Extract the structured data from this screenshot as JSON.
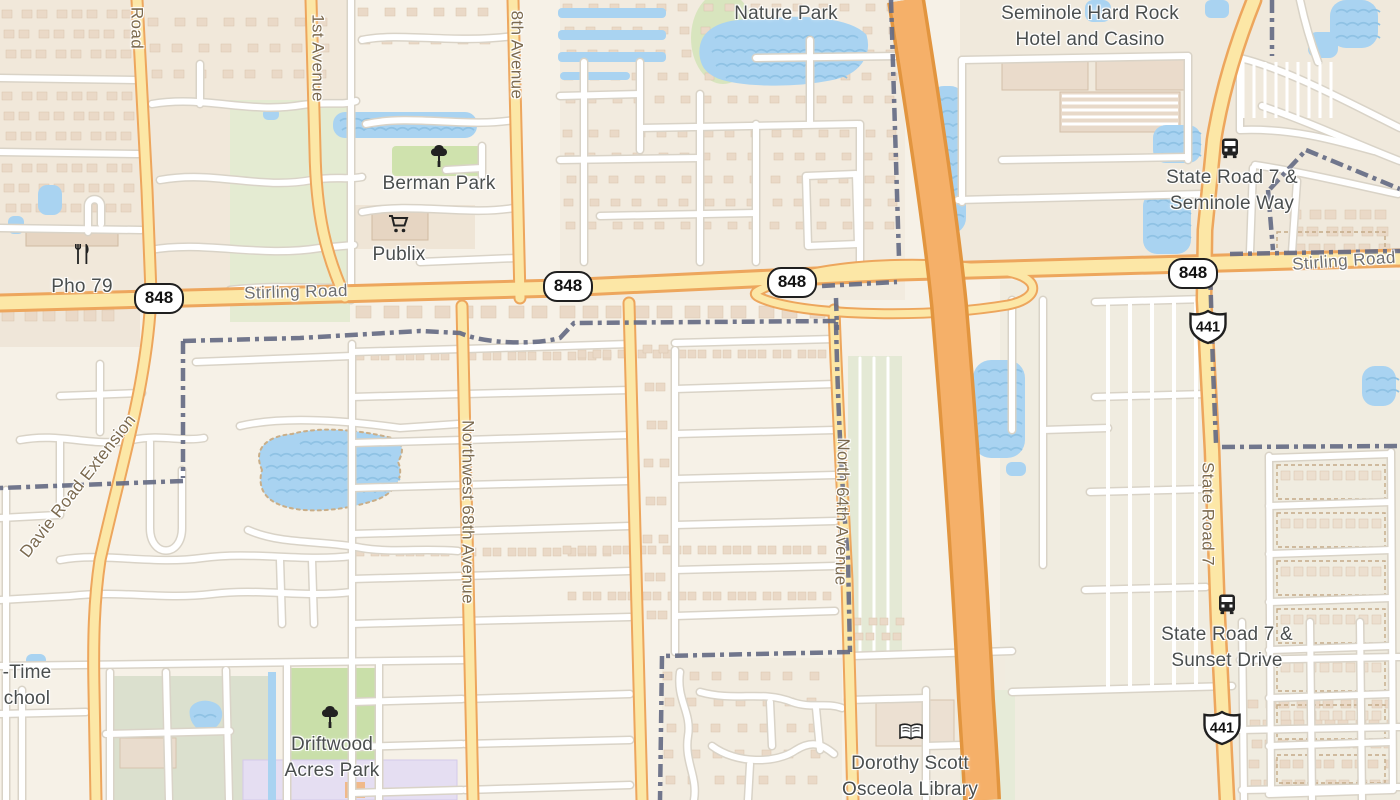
{
  "map": {
    "canvas": {
      "width": 1400,
      "height": 800
    },
    "colors": {
      "land": "#f6f1e7",
      "water": "#a9d3f1",
      "wave": "#8fc2e4",
      "park_green": "#cfe2ad",
      "school_green": "#dbe0ce",
      "road_yellow_fill": "#fce7a6",
      "road_yellow_casing": "#eda65d",
      "highway_fill": "#f5b069",
      "highway_casing": "#e2953f",
      "minor_road_fill": "#ffffff",
      "minor_road_casing": "#d9d3c7",
      "boundary_dash": "#656b84",
      "building": "#ead9c7",
      "campus_purple": "#e5def2",
      "label_place": "#4a4e4e",
      "label_road": "#6e6e6e",
      "label_avenue": "#7b6a4f"
    },
    "labels": [
      {
        "id": "nature-park",
        "kind": "place",
        "text": "Nature Park",
        "x": 786,
        "y": 14
      },
      {
        "id": "seminole-hard-rock",
        "kind": "place",
        "lines": [
          "Seminole Hard Rock",
          "Hotel and Casino"
        ],
        "x": 1090,
        "y": 27
      },
      {
        "id": "state-road-7-seminole-way",
        "kind": "place",
        "lines": [
          "State Road 7 &",
          "Seminole Way"
        ],
        "x": 1232,
        "y": 191
      },
      {
        "id": "state-road-7-sunset-drive",
        "kind": "place",
        "lines": [
          "State Road 7 &",
          "Sunset Drive"
        ],
        "x": 1227,
        "y": 648
      },
      {
        "id": "dorothy-scott-osceola-library",
        "kind": "place",
        "lines": [
          "Dorothy Scott",
          "Osceola Library"
        ],
        "x": 910,
        "y": 777
      },
      {
        "id": "driftwood-acres-park",
        "kind": "place",
        "lines": [
          "Driftwood",
          "Acres Park"
        ],
        "x": 332,
        "y": 758
      },
      {
        "id": "berman-park",
        "kind": "place",
        "text": "Berman Park",
        "x": 439,
        "y": 184
      },
      {
        "id": "publix",
        "kind": "place",
        "text": "Publix",
        "x": 399,
        "y": 255
      },
      {
        "id": "pho-79",
        "kind": "place",
        "text": "Pho 79",
        "x": 82,
        "y": 287
      },
      {
        "id": "school-label-clipped",
        "kind": "place",
        "lines": [
          "-Time",
          "chool"
        ],
        "x": 27,
        "y": 686
      },
      {
        "id": "stirling-road-west",
        "kind": "road",
        "text": "Stirling Road",
        "x": 296,
        "y": 292,
        "rotate": -1.5
      },
      {
        "id": "stirling-road-east",
        "kind": "road",
        "text": "Stirling Road",
        "x": 1344,
        "y": 261,
        "rotate": -4
      },
      {
        "id": "davie-road",
        "kind": "avenue",
        "text": "Road",
        "x": 137,
        "y": 28,
        "rotate": 90
      },
      {
        "id": "1st-avenue",
        "kind": "avenue",
        "text": "1st Avenue",
        "x": 318,
        "y": 58,
        "rotate": 90
      },
      {
        "id": "8th-avenue",
        "kind": "avenue",
        "text": "8th Avenue",
        "x": 517,
        "y": 55,
        "rotate": 90
      },
      {
        "id": "northwest-68th-avenue",
        "kind": "avenue",
        "text": "Northwest 68th Avenue",
        "x": 468,
        "y": 512,
        "rotate": 90
      },
      {
        "id": "north-64th-avenue",
        "kind": "avenue",
        "text": "North 64th Avenue",
        "x": 842,
        "y": 512,
        "rotate": 91
      },
      {
        "id": "state-road-7",
        "kind": "avenue",
        "text": "State Road 7",
        "x": 1208,
        "y": 514,
        "rotate": 90
      },
      {
        "id": "davie-road-extension",
        "kind": "avenue",
        "text": "Davie Road Extension",
        "x": 78,
        "y": 486,
        "rotate": -52
      }
    ],
    "shields": [
      {
        "id": "shield-848-a",
        "shape": "oval",
        "text": "848",
        "x": 157,
        "y": 296
      },
      {
        "id": "shield-848-b",
        "shape": "oval",
        "text": "848",
        "x": 566,
        "y": 284
      },
      {
        "id": "shield-848-c",
        "shape": "oval",
        "text": "848",
        "x": 790,
        "y": 280
      },
      {
        "id": "shield-848-d",
        "shape": "oval",
        "text": "848",
        "x": 1191,
        "y": 271
      },
      {
        "id": "shield-441-a",
        "shape": "us",
        "text": "441",
        "x": 1208,
        "y": 327
      },
      {
        "id": "shield-441-b",
        "shape": "us",
        "text": "441",
        "x": 1222,
        "y": 728
      }
    ],
    "pois": [
      {
        "id": "berman-park-marker",
        "icon": "tree-icon",
        "x": 439,
        "y": 156
      },
      {
        "id": "driftwood-park-marker",
        "icon": "tree-icon",
        "x": 330,
        "y": 717
      },
      {
        "id": "publix-marker",
        "icon": "shopping-cart-icon",
        "x": 399,
        "y": 224
      },
      {
        "id": "pho-79-marker",
        "icon": "restaurant-icon",
        "x": 83,
        "y": 254
      },
      {
        "id": "bus-stop-seminole-way",
        "icon": "bus-icon",
        "x": 1230,
        "y": 148
      },
      {
        "id": "bus-stop-sunset-drive",
        "icon": "bus-icon",
        "x": 1227,
        "y": 604
      },
      {
        "id": "library-marker",
        "icon": "book-icon",
        "x": 911,
        "y": 732
      }
    ]
  }
}
